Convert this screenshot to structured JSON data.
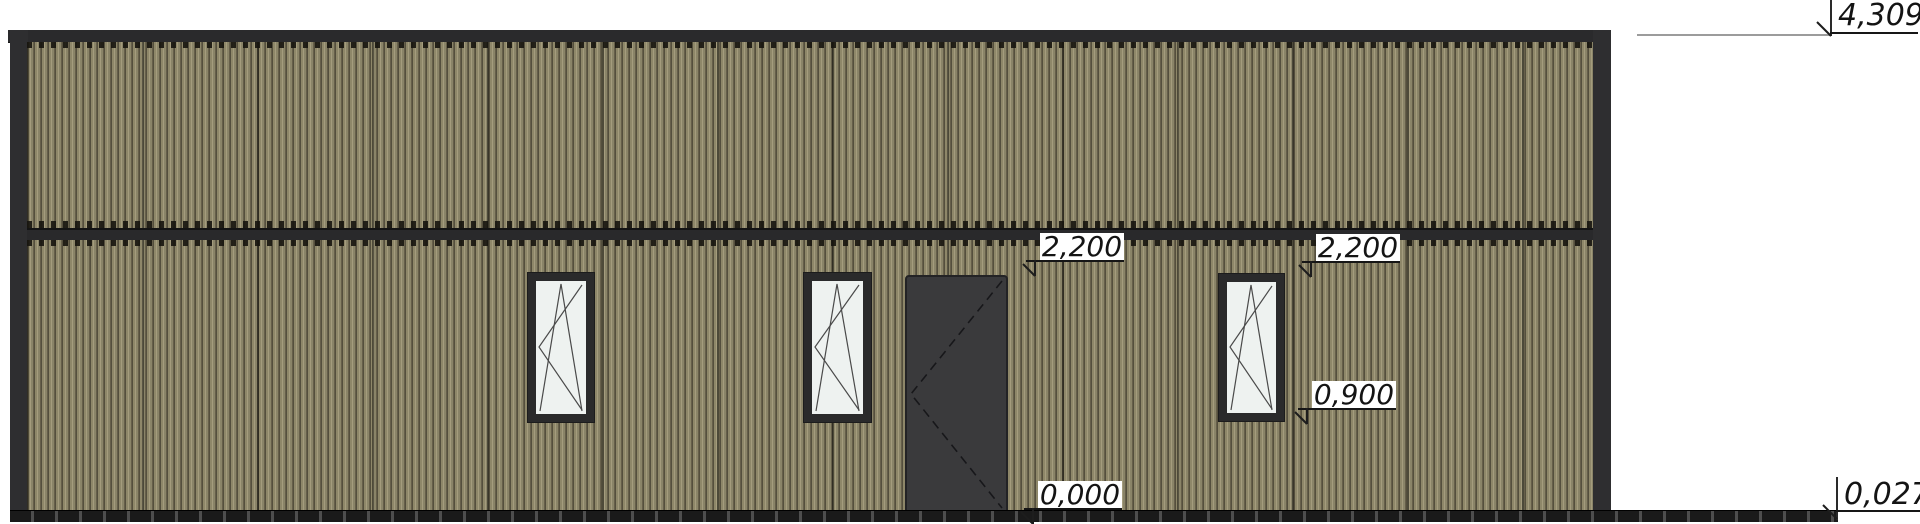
{
  "drawing": {
    "kind": "building-front-elevation",
    "levels": {
      "roof_top": "4,309",
      "opening_top_left": "2,200",
      "opening_top_right": "2,200",
      "window_sill": "0,900",
      "finished_floor": "0,000",
      "plinth": "0,027"
    },
    "elements": {
      "windows_count": 3,
      "door_count": 1,
      "window_symbol": "tilt-turn",
      "door_symbol": "hinged-right-dashed-swing"
    },
    "colors": {
      "cladding_base": "#8e8769",
      "cladding_highlight": "#a49c7d",
      "cladding_shadow": "#544f3d",
      "trim_dark": "#2e2e30",
      "door_fill": "#3a3a3c",
      "glass": "#eef2f0",
      "dimension_leader": "#9c9c9c",
      "text": "#141414",
      "background": "#ffffff"
    }
  }
}
